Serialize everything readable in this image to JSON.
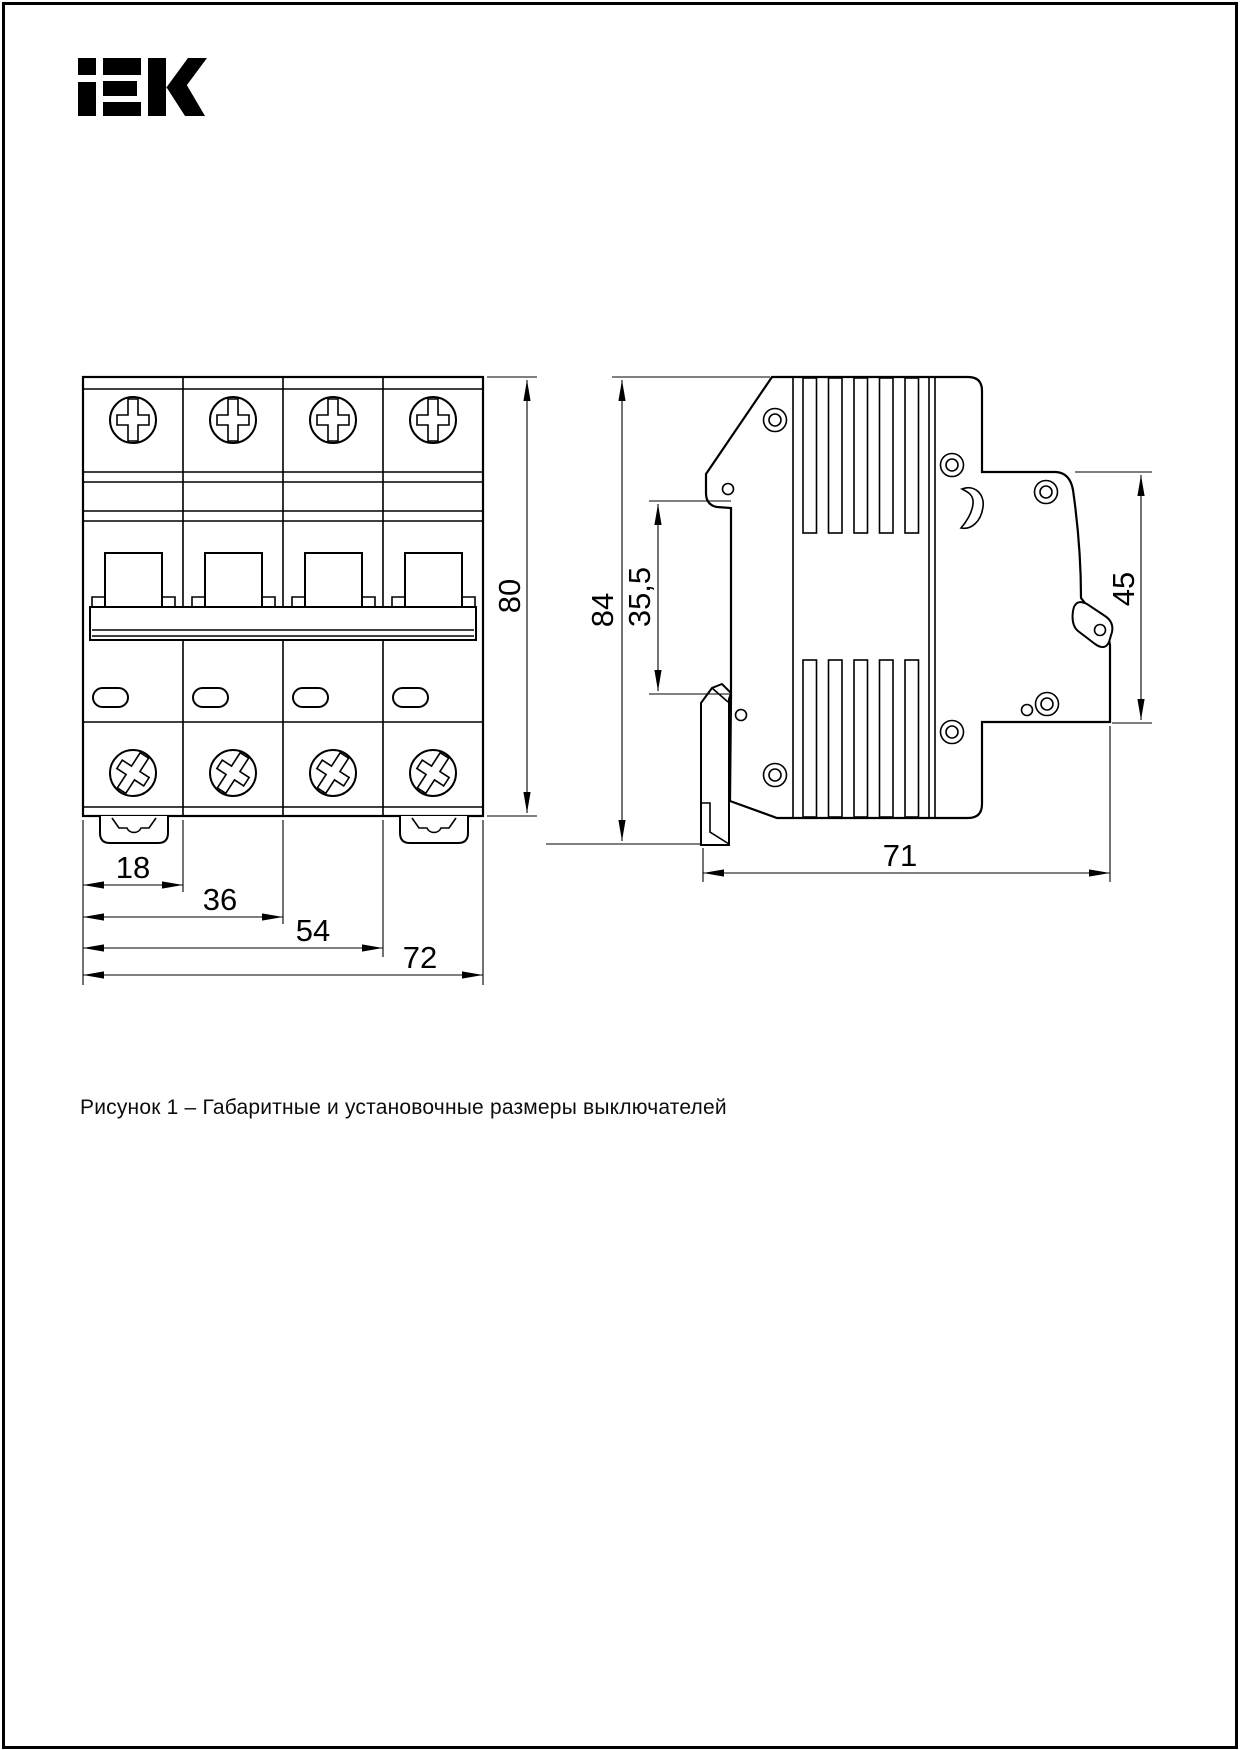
{
  "page": {
    "background": "#ffffff",
    "border_color": "#000000"
  },
  "logo": {
    "brand": "IEK"
  },
  "figure": {
    "caption": "Рисунок 1 – Габаритные и установочные размеры выключателей"
  },
  "front_view": {
    "dims": {
      "one_module": "18",
      "two_modules": "36",
      "three_modules": "54",
      "total_width": "72",
      "height": "80"
    }
  },
  "side_view": {
    "dims": {
      "total_height": "84",
      "din_rail_height": "35,5",
      "front_height": "45",
      "depth": "71"
    }
  }
}
